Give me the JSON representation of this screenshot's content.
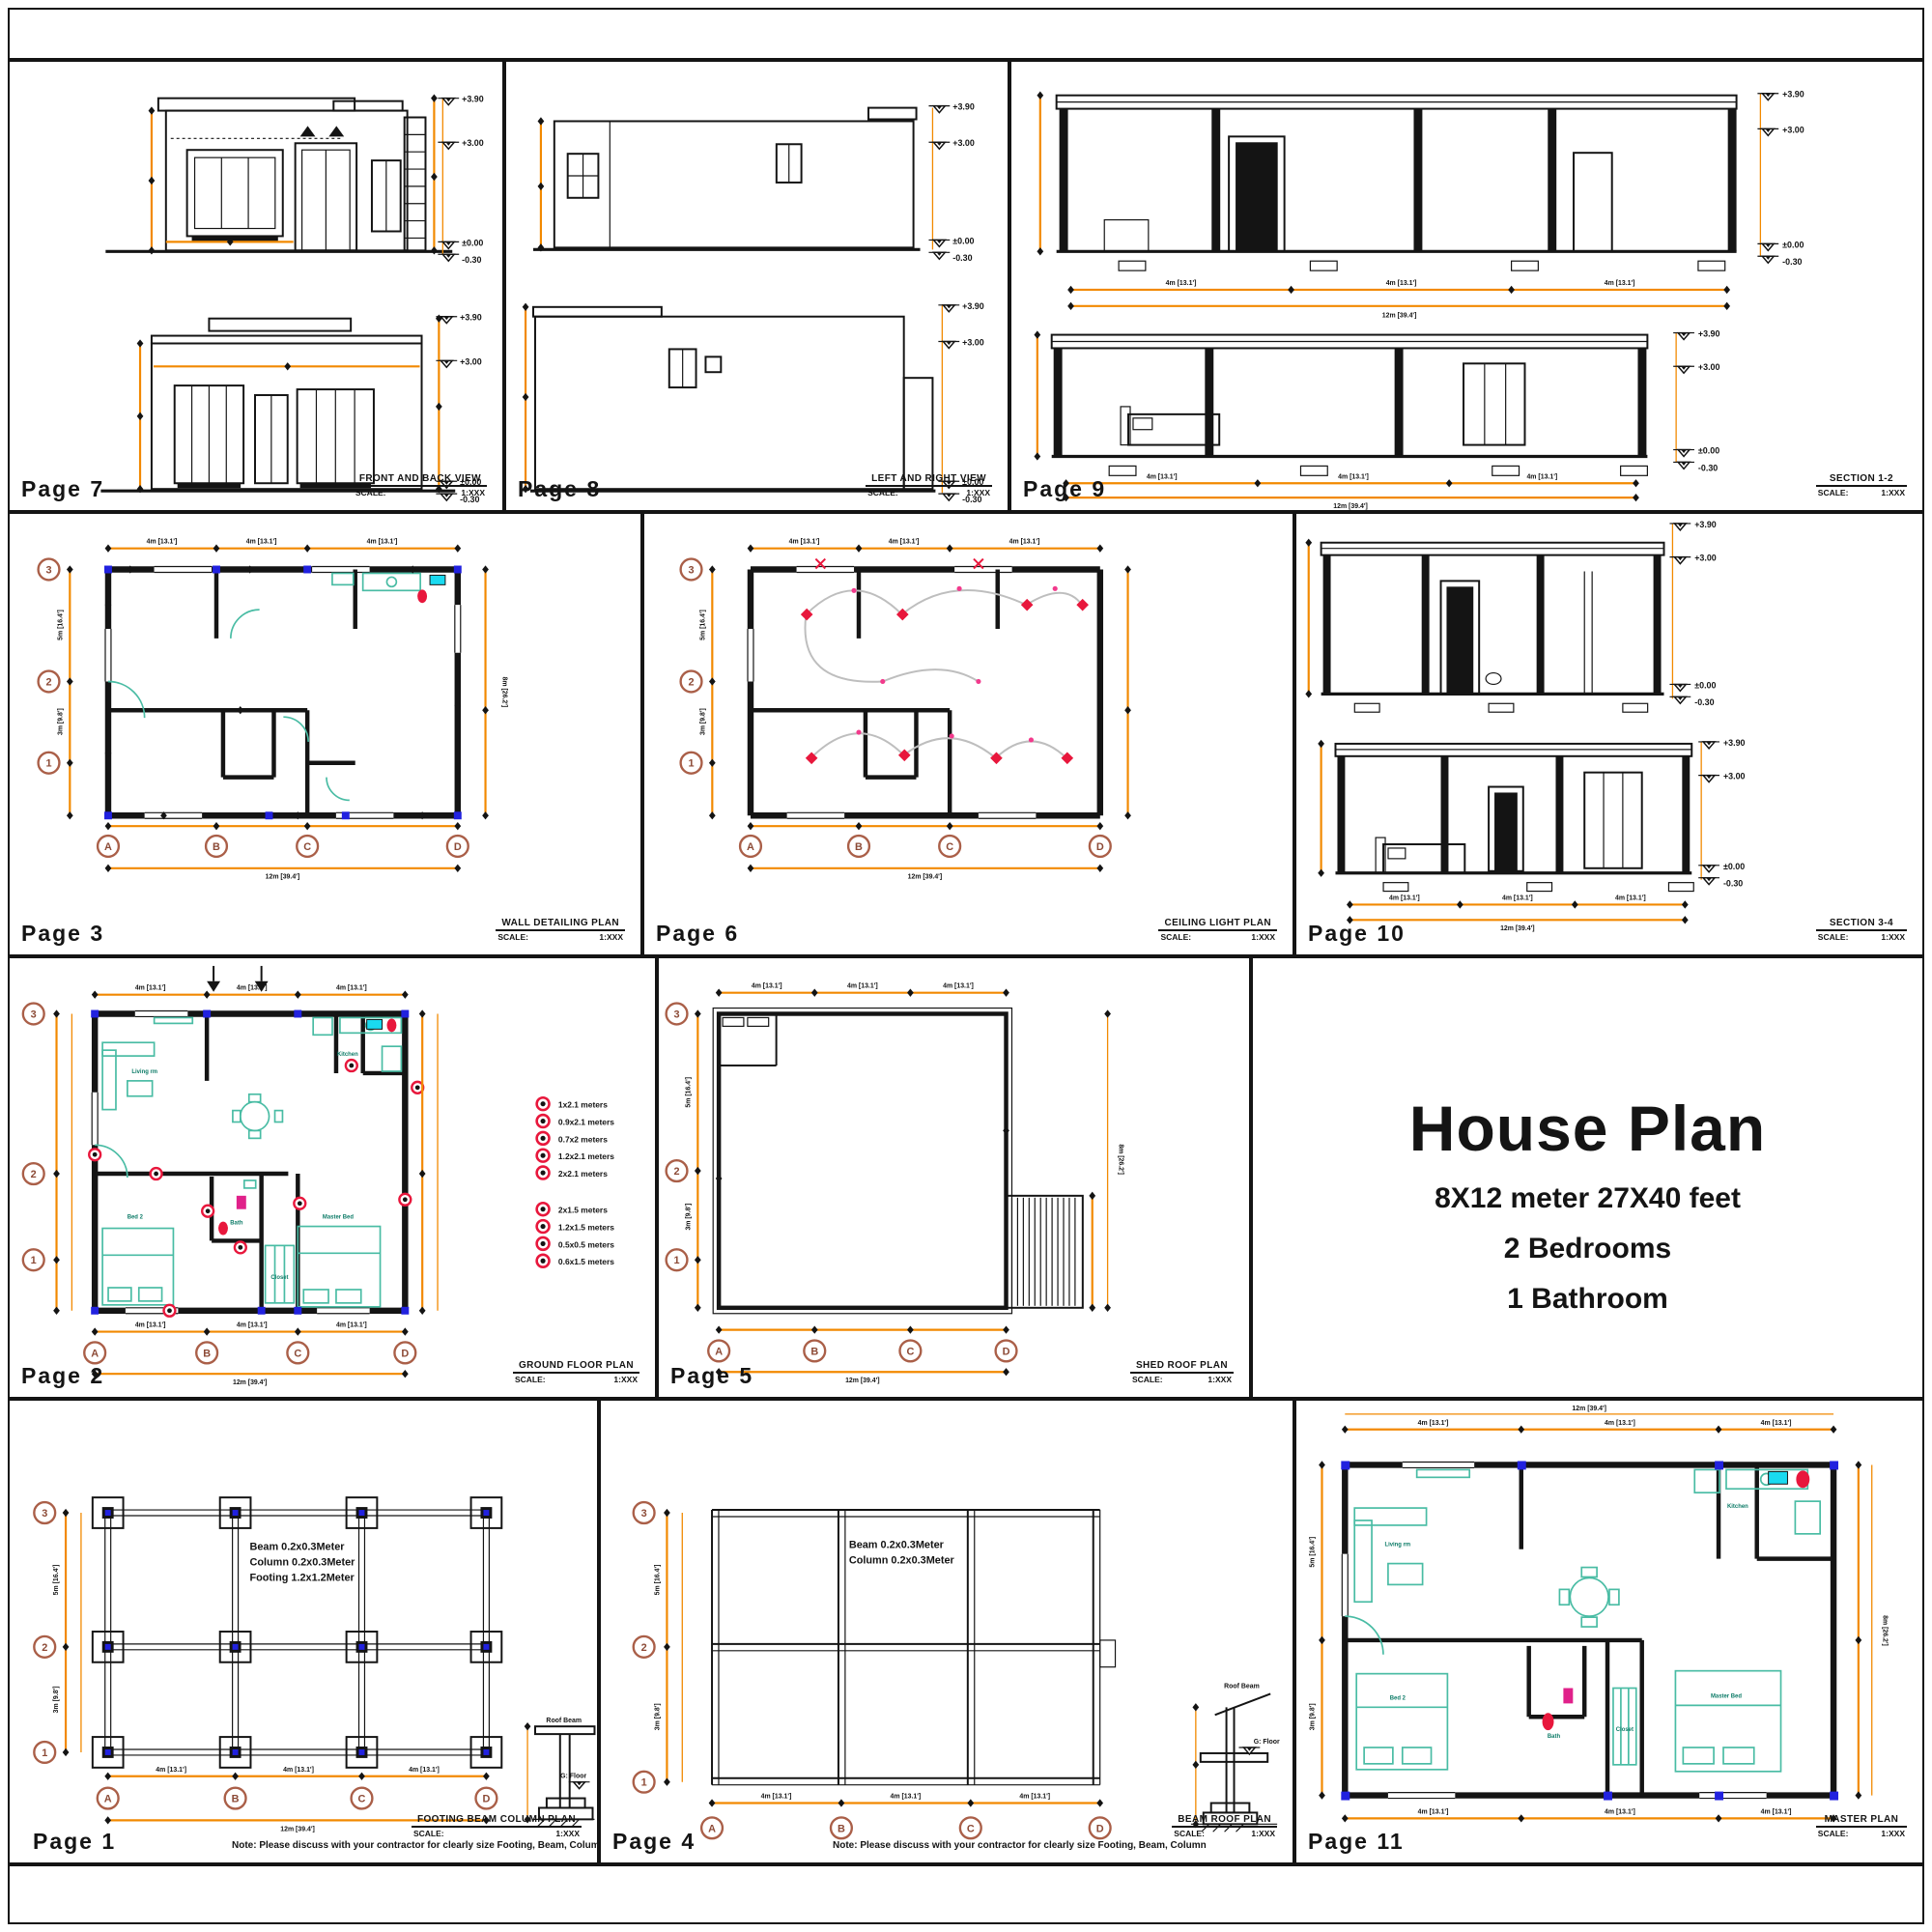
{
  "document": {
    "title_block": {
      "title": "House Plan",
      "subtitle1": "8X12 meter 27X40 feet",
      "subtitle2": "2 Bedrooms",
      "subtitle3": "1 Bathroom"
    }
  },
  "labels": {
    "scale": "SCALE:",
    "scale_value": "1:XXX",
    "note": "Note: Please discuss with your contractor for clearly size Footing, Beam, Column"
  },
  "grid": {
    "rows": [
      "3",
      "2",
      "1"
    ],
    "cols": [
      "A",
      "B",
      "C",
      "D"
    ]
  },
  "elevation_markers": [
    "+3.90",
    "+3.00",
    "±0.00",
    "-0.30"
  ],
  "dims": {
    "d4": "4m [13.1']",
    "d12": "12m [39.4']",
    "d3": "3m [9.8']",
    "d5": "5m [16.4']",
    "d8": "8m [26.2']"
  },
  "panels": {
    "p7": {
      "page": "Page 7",
      "title": "FRONT AND BACK VIEW"
    },
    "p8": {
      "page": "Page 8",
      "title": "LEFT AND RIGHT VIEW"
    },
    "p9": {
      "page": "Page 9",
      "title": "SECTION 1-2"
    },
    "p3": {
      "page": "Page 3",
      "title": "WALL DETAILING PLAN"
    },
    "p6": {
      "page": "Page 6",
      "title": "CEILING LIGHT PLAN"
    },
    "p10": {
      "page": "Page 10",
      "title": "SECTION 3-4"
    },
    "p2": {
      "page": "Page 2",
      "title": "GROUND FLOOR PLAN"
    },
    "p5": {
      "page": "Page 5",
      "title": "SHED ROOF PLAN"
    },
    "p1": {
      "page": "Page 1",
      "title": "FOOTING BEAM COLUMN PLAN",
      "spec": [
        "Beam  0.2x0.3Meter",
        "Column  0.2x0.3Meter",
        "Footing  1.2x1.2Meter"
      ],
      "detail": {
        "top": "Roof Beam",
        "floor": "G: Floor"
      }
    },
    "p4": {
      "page": "Page 4",
      "title": "BEAM ROOF PLAN",
      "spec": [
        "Beam  0.2x0.3Meter",
        "Column  0.2x0.3Meter"
      ],
      "detail": {
        "top": "Roof Beam",
        "floor": "G: Floor"
      }
    },
    "p11": {
      "page": "Page 11",
      "title": "MASTER PLAN"
    }
  },
  "legend": {
    "doors": [
      "1x2.1 meters",
      "0.9x2.1 meters",
      "0.7x2 meters",
      "1.2x2.1 meters",
      "2x2.1 meters"
    ],
    "windows": [
      "2x1.5 meters",
      "1.2x1.5 meters",
      "0.5x0.5 meters",
      "0.6x1.5 meters"
    ]
  },
  "rooms": {
    "living": "Living rm",
    "kitchen": "Kitchen",
    "bed2": "Bed 2",
    "master": "Master Bed",
    "bath": "Bath",
    "closet": "Closet"
  }
}
